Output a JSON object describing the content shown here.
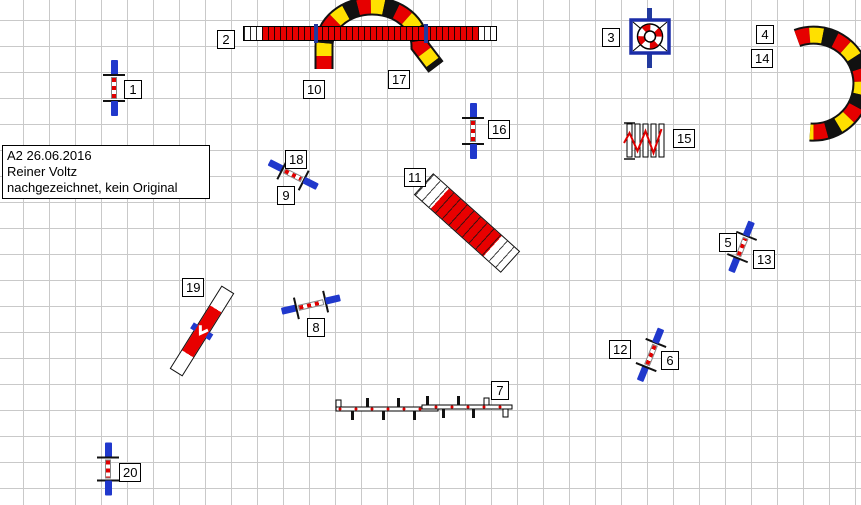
{
  "info_box": {
    "line1": "A2 26.06.2016",
    "line2": "Reiner Voltz",
    "line3": "nachgezeichnet, kein Original"
  },
  "labels": {
    "n1": "1",
    "n2": "2",
    "n3": "3",
    "n4": "4",
    "n5": "5",
    "n6": "6",
    "n7": "7",
    "n8": "8",
    "n9": "9",
    "n10": "10",
    "n11": "11",
    "n12": "12",
    "n13": "13",
    "n14": "14",
    "n15": "15",
    "n16": "16",
    "n17": "17",
    "n18": "18",
    "n19": "19",
    "n20": "20"
  },
  "colors": {
    "obstacle_red": "#e80000",
    "tunnel_yellow": "#ffe000",
    "tunnel_black": "#111111",
    "wing_blue": "#2038cc",
    "tire_frame_navy": "#1b2da8",
    "grid_line": "#c9c9c9",
    "label_text": "#000000"
  }
}
